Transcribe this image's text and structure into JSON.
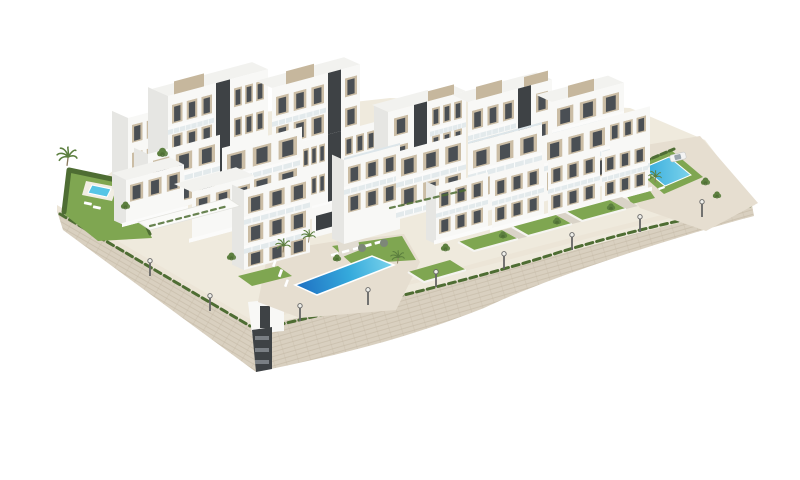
{
  "image": {
    "type": "architectural-3d-render",
    "subject": "Aerial 3D rendering of a modern white residential apartment complex built on a terraced hillside over large stone retaining walls",
    "background": "#ffffff"
  },
  "palette": {
    "background": "#ffffff",
    "building_white": "#f8f8f6",
    "building_shade": "#e6e6e3",
    "building_deep_shade": "#d4d4d1",
    "core_dark": "#3e4245",
    "window_dark": "#4a4f54",
    "panel_beige": "#cbbda5",
    "penthouse_beige": "#c6b79d",
    "glass_rail": "#dde6ea",
    "wall_stone": "#d9d0c0",
    "wall_course": "#bfb4a0",
    "walkway": "#ece5d7",
    "terrace_sand": "#e6ded0",
    "path_gray": "#d9d3c7",
    "lawn_green": "#7fa651",
    "lawn_dark": "#6d9644",
    "hedge_green": "#4e6d33",
    "tree_green": "#5c7f3f",
    "pool_deep": "#1e6fc2",
    "pool_mid": "#35aadc",
    "pool_light": "#7cd4ec",
    "pool_small": "#56c5e6",
    "car_white": "#f4f4f4",
    "lamp_gray": "#666666",
    "white_trim": "#f5f4f0"
  },
  "scene": {
    "buildings": {
      "count": 18,
      "style": "cubic white apartment blocks of 2-5 storeys with beige window panels, dark glazing, glass balconies, charcoal stair cores and beige rooftop penthouses"
    },
    "pools": [
      {
        "name": "main-community-pool",
        "shape": "long infinity pool",
        "colors": [
          "deep blue",
          "turquoise"
        ]
      },
      {
        "name": "left-garden-pool",
        "shape": "small rectangular pool",
        "colors": [
          "light turquoise"
        ]
      },
      {
        "name": "right-community-pool",
        "shape": "small lap pool",
        "colors": [
          "turquoise"
        ]
      }
    ],
    "landscape": [
      "large beige stone retaining walls",
      "promenade walkway with street lamps",
      "hedge lines along wall tops",
      "private lawn gardens with low white walls",
      "palm trees and small trees",
      "sun loungers and parasols"
    ],
    "vehicles": [
      {
        "name": "white-car",
        "count": 1
      }
    ]
  }
}
